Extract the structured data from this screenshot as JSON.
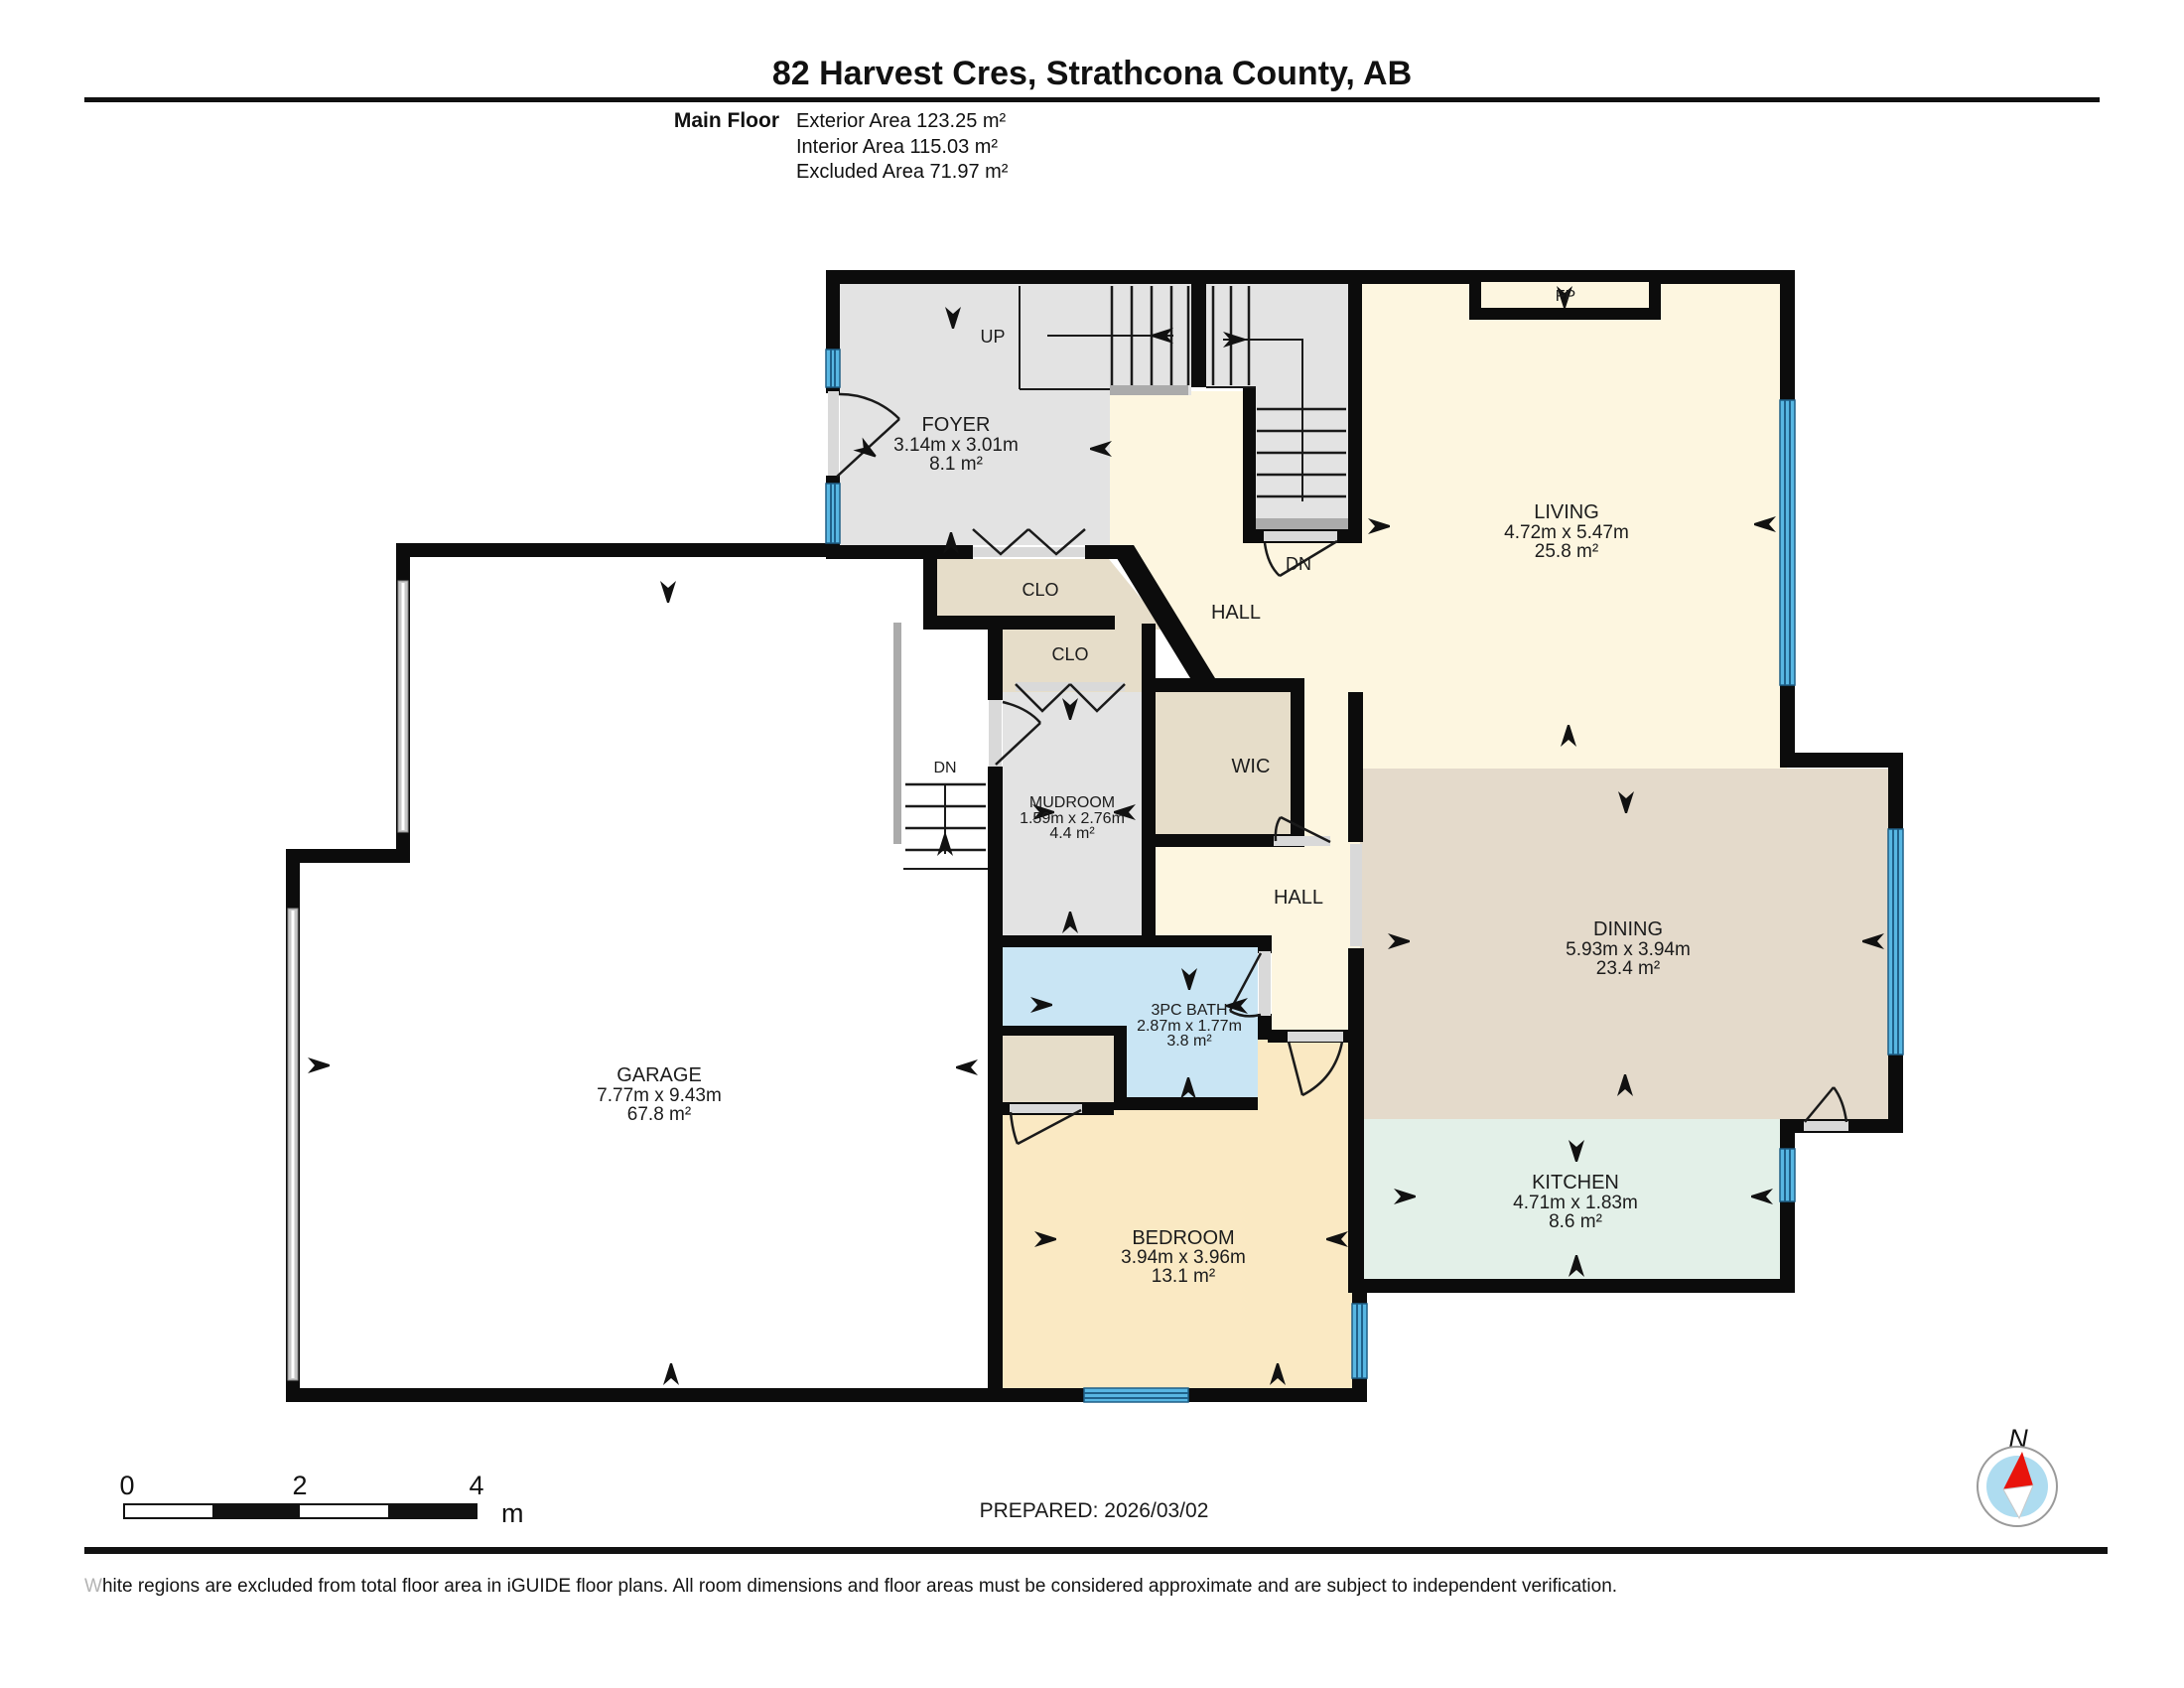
{
  "header": {
    "title": "82 Harvest Cres, Strathcona County, AB",
    "floor_label": "Main Floor",
    "stats": [
      "Exterior Area 123.25 m²",
      "Interior Area 115.03 m²",
      "Excluded Area 71.97 m²"
    ]
  },
  "rooms": {
    "foyer": {
      "name": "FOYER",
      "dims": "3.14m x 3.01m",
      "area": "8.1 m²"
    },
    "living": {
      "name": "LIVING",
      "dims": "4.72m x 5.47m",
      "area": "25.8 m²"
    },
    "mudroom": {
      "name": "MUDROOM",
      "dims": "1.59m x 2.76m",
      "area": "4.4 m²"
    },
    "dining": {
      "name": "DINING",
      "dims": "5.93m x 3.94m",
      "area": "23.4 m²"
    },
    "garage": {
      "name": "GARAGE",
      "dims": "7.77m x 9.43m",
      "area": "67.8 m²"
    },
    "bath": {
      "name": "3PC BATH",
      "dims": "2.87m x 1.77m",
      "area": "3.8 m²"
    },
    "bedroom": {
      "name": "BEDROOM",
      "dims": "3.94m x 3.96m",
      "area": "13.1 m²"
    },
    "kitchen": {
      "name": "KITCHEN",
      "dims": "4.71m x 1.83m",
      "area": "8.6 m²"
    },
    "wic": "WIC",
    "hall_upper": "HALL",
    "hall_lower": "HALL",
    "closet1": "CLO",
    "closet2": "CLO",
    "fireplace": "FP",
    "stair_up": "UP",
    "stair_down_main": "DN",
    "stair_down_basement": "DN"
  },
  "footer": {
    "scale_ticks": [
      "0",
      "2",
      "4"
    ],
    "scale_unit": "m",
    "prepared": "PREPARED: 2026/03/02",
    "compass": "N",
    "disclaimer_lead": "W",
    "disclaimer_rest": "hite regions are excluded from total floor area in iGUIDE floor plans. All room dimensions and floor areas must be considered approximate and are subject to independent verification."
  },
  "colors": {
    "wall": "#0c0c0c",
    "floor_gray": "#e3e3e3",
    "floor_cream": "#fdf6e0",
    "floor_tan": "#e6ddc9",
    "floor_dining": "#e4dacb",
    "floor_bath_blue": "#c9e5f4",
    "floor_bedroom": "#fae9c3",
    "floor_kitchen": "#e3f0e8",
    "window_blue": "#58b7e3",
    "compass_blue": "#aedcf0",
    "compass_red": "#e8140c"
  }
}
